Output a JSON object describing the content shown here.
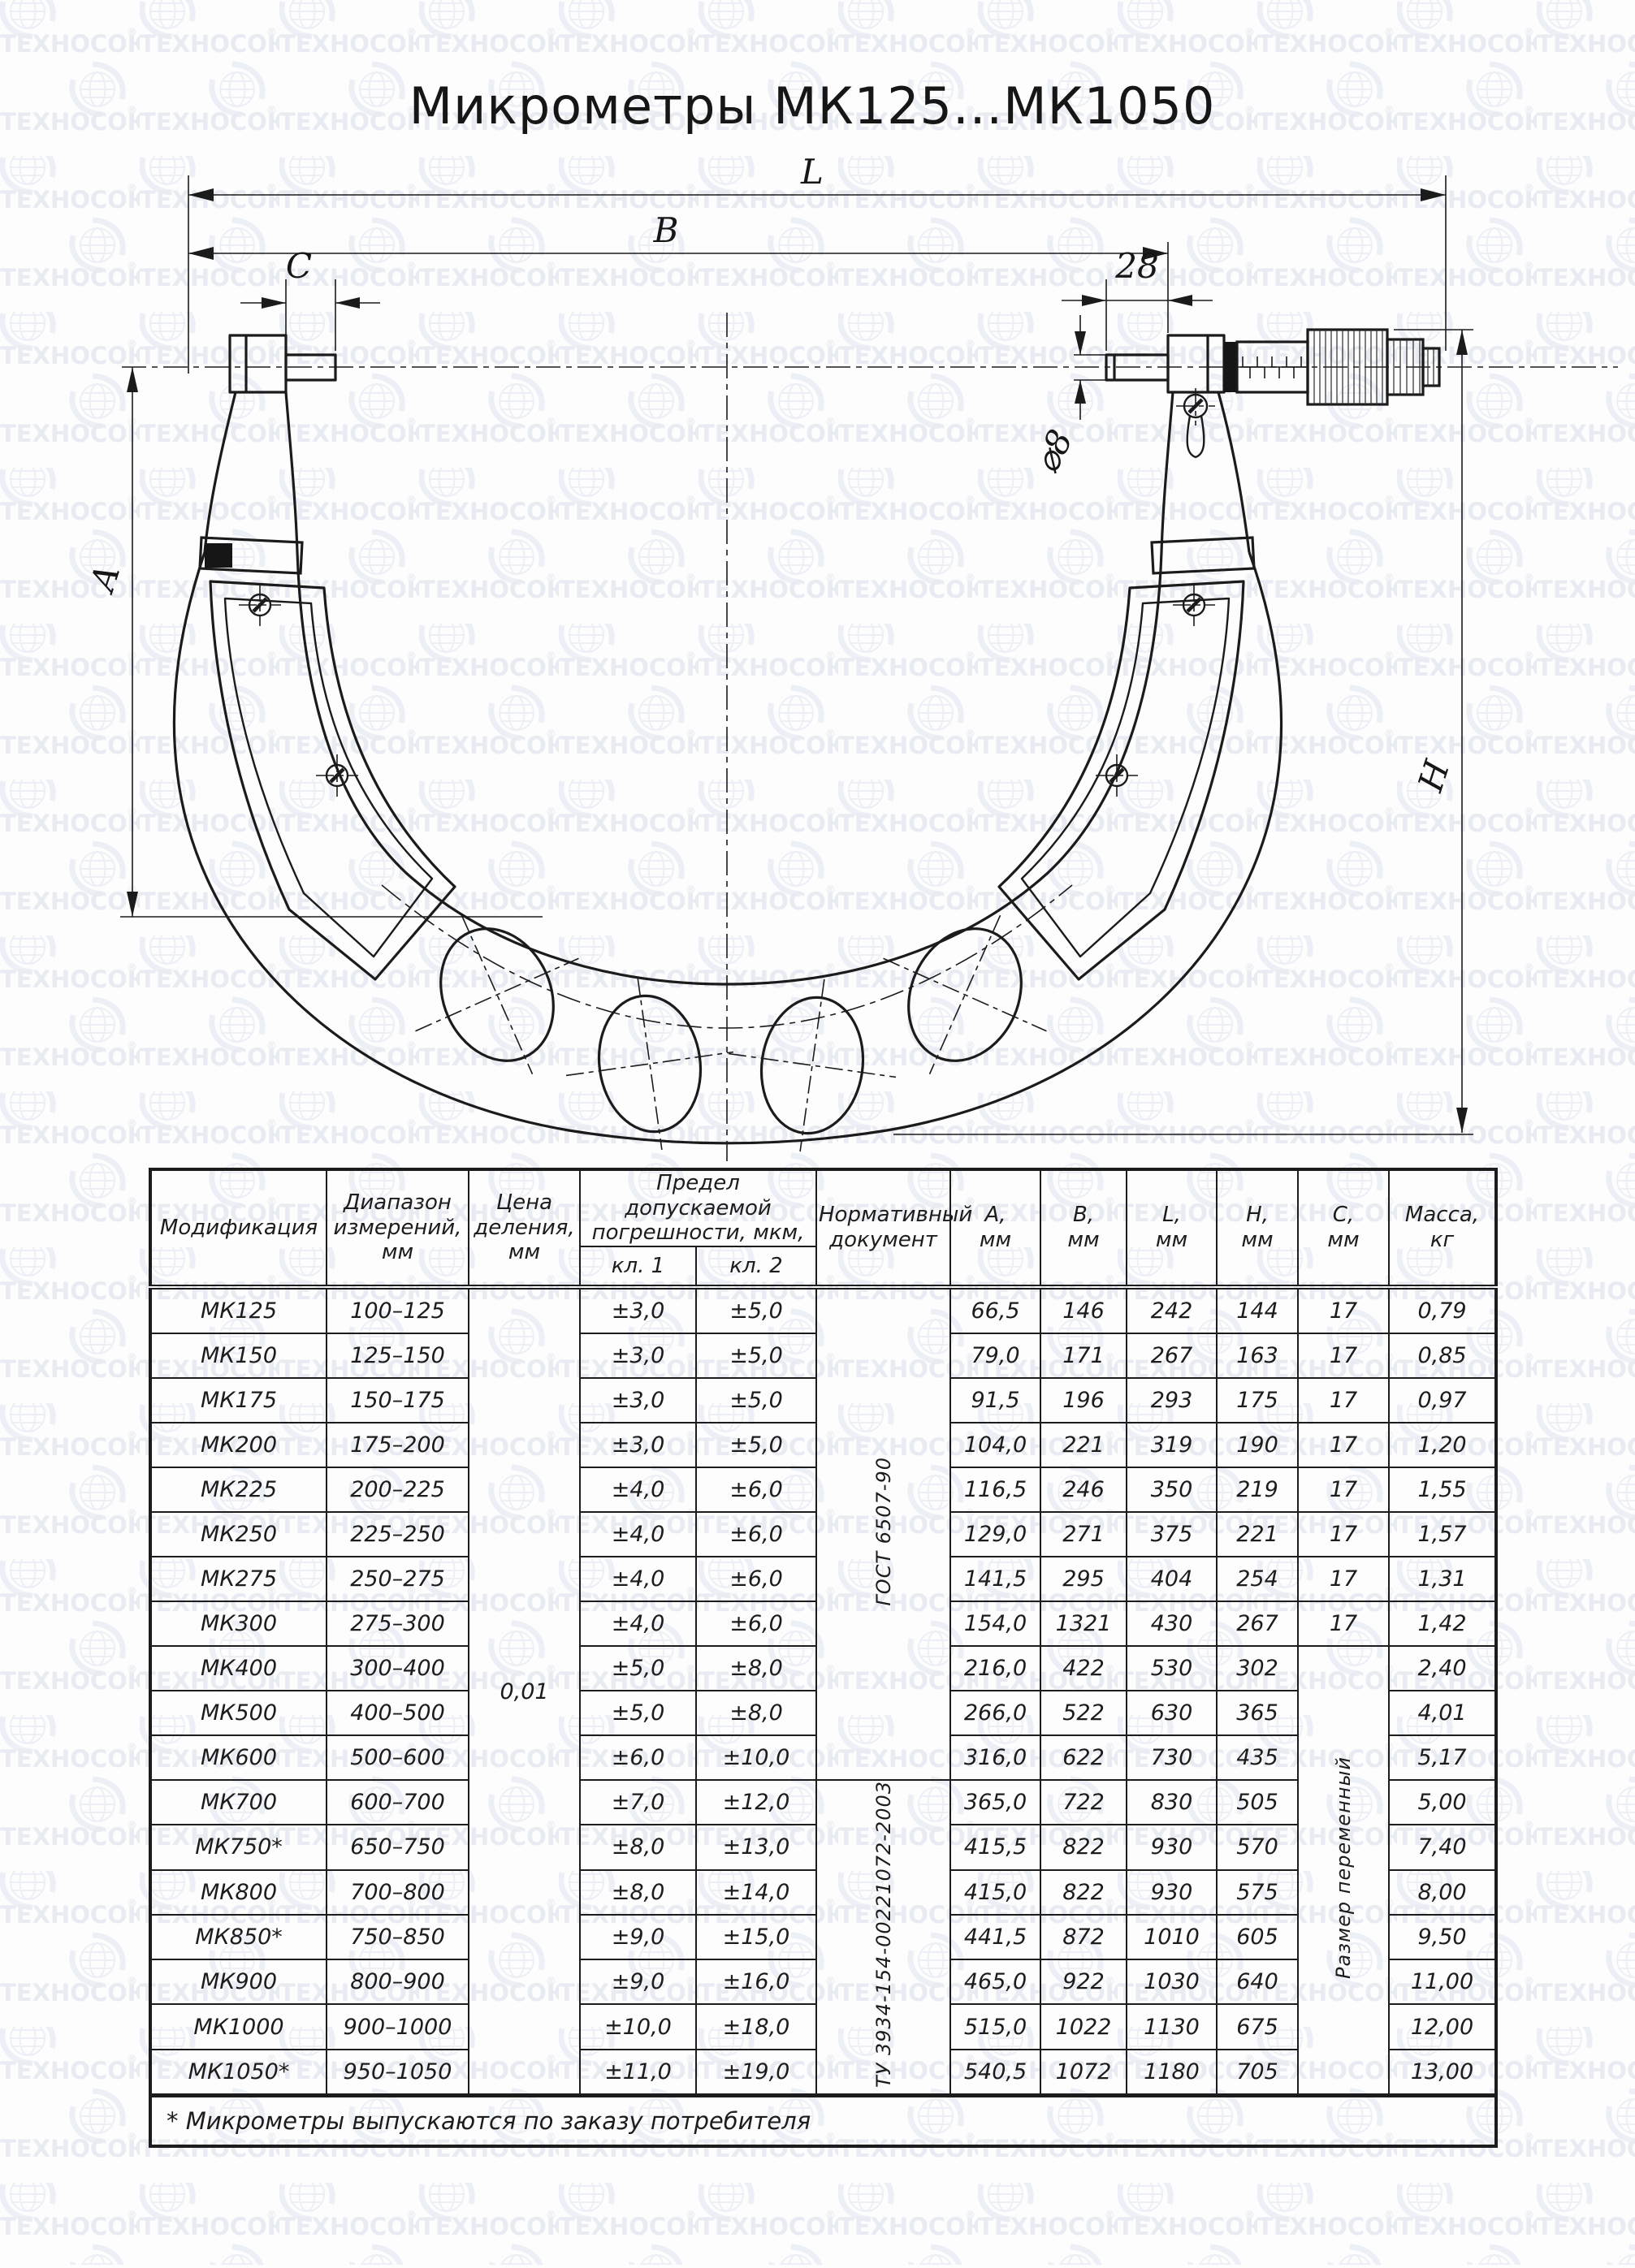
{
  "title": "Микрометры МК125...МК1050",
  "watermark": {
    "text": "ТЕХНОСОЮЗ",
    "reg": "®"
  },
  "drawing": {
    "dims": {
      "L": "L",
      "B": "B",
      "C": "C",
      "d28": "28",
      "dia8": "⌀8",
      "A": "A",
      "H": "H"
    }
  },
  "table": {
    "headers": {
      "modification": "Модификация",
      "range": "Диапазон\nизмерений,\nмм",
      "step": "Цена\nделения,\nмм",
      "error_limit": "Предел допускаемой\nпогрешности, мкм,",
      "class1": "кл. 1",
      "class2": "кл. 2",
      "document": "Нормативный\nдокумент",
      "a": "А,\nмм",
      "b": "В,\nмм",
      "l": "L,\nмм",
      "h": "Н,\nмм",
      "c": "С,\nмм",
      "mass": "Масса,\nкг"
    },
    "step_value": "0,01",
    "documents": {
      "gost": "ГОСТ 6507-90",
      "gost_rows": 11,
      "tu": "ТУ 3934-154-00221072-2003",
      "tu_rows": 7
    },
    "c_variable": {
      "label": "Размер переменный",
      "rows": 10
    },
    "rows": [
      {
        "model": "МК125",
        "range": "100–125",
        "kl1": "±3,0",
        "kl2": "±5,0",
        "a": "66,5",
        "b": "146",
        "l": "242",
        "h": "144",
        "c": "17",
        "mass": "0,79"
      },
      {
        "model": "МК150",
        "range": "125–150",
        "kl1": "±3,0",
        "kl2": "±5,0",
        "a": "79,0",
        "b": "171",
        "l": "267",
        "h": "163",
        "c": "17",
        "mass": "0,85"
      },
      {
        "model": "МК175",
        "range": "150–175",
        "kl1": "±3,0",
        "kl2": "±5,0",
        "a": "91,5",
        "b": "196",
        "l": "293",
        "h": "175",
        "c": "17",
        "mass": "0,97"
      },
      {
        "model": "МК200",
        "range": "175–200",
        "kl1": "±3,0",
        "kl2": "±5,0",
        "a": "104,0",
        "b": "221",
        "l": "319",
        "h": "190",
        "c": "17",
        "mass": "1,20"
      },
      {
        "model": "МК225",
        "range": "200–225",
        "kl1": "±4,0",
        "kl2": "±6,0",
        "a": "116,5",
        "b": "246",
        "l": "350",
        "h": "219",
        "c": "17",
        "mass": "1,55"
      },
      {
        "model": "МК250",
        "range": "225–250",
        "kl1": "±4,0",
        "kl2": "±6,0",
        "a": "129,0",
        "b": "271",
        "l": "375",
        "h": "221",
        "c": "17",
        "mass": "1,57"
      },
      {
        "model": "МК275",
        "range": "250–275",
        "kl1": "±4,0",
        "kl2": "±6,0",
        "a": "141,5",
        "b": "295",
        "l": "404",
        "h": "254",
        "c": "17",
        "mass": "1,31"
      },
      {
        "model": "МК300",
        "range": "275–300",
        "kl1": "±4,0",
        "kl2": "±6,0",
        "a": "154,0",
        "b": "1321",
        "l": "430",
        "h": "267",
        "c": "17",
        "mass": "1,42"
      },
      {
        "model": "МК400",
        "range": "300–400",
        "kl1": "±5,0",
        "kl2": "±8,0",
        "a": "216,0",
        "b": "422",
        "l": "530",
        "h": "302",
        "c": "",
        "mass": "2,40"
      },
      {
        "model": "МК500",
        "range": "400–500",
        "kl1": "±5,0",
        "kl2": "±8,0",
        "a": "266,0",
        "b": "522",
        "l": "630",
        "h": "365",
        "c": "",
        "mass": "4,01"
      },
      {
        "model": "МК600",
        "range": "500–600",
        "kl1": "±6,0",
        "kl2": "±10,0",
        "a": "316,0",
        "b": "622",
        "l": "730",
        "h": "435",
        "c": "",
        "mass": "5,17"
      },
      {
        "model": "МК700",
        "range": "600–700",
        "kl1": "±7,0",
        "kl2": "±12,0",
        "a": "365,0",
        "b": "722",
        "l": "830",
        "h": "505",
        "c": "",
        "mass": "5,00"
      },
      {
        "model": "МК750*",
        "range": "650–750",
        "kl1": "±8,0",
        "kl2": "±13,0",
        "a": "415,5",
        "b": "822",
        "l": "930",
        "h": "570",
        "c": "",
        "mass": "7,40"
      },
      {
        "model": "МК800",
        "range": "700–800",
        "kl1": "±8,0",
        "kl2": "±14,0",
        "a": "415,0",
        "b": "822",
        "l": "930",
        "h": "575",
        "c": "",
        "mass": "8,00"
      },
      {
        "model": "МК850*",
        "range": "750–850",
        "kl1": "±9,0",
        "kl2": "±15,0",
        "a": "441,5",
        "b": "872",
        "l": "1010",
        "h": "605",
        "c": "",
        "mass": "9,50"
      },
      {
        "model": "МК900",
        "range": "800–900",
        "kl1": "±9,0",
        "kl2": "±16,0",
        "a": "465,0",
        "b": "922",
        "l": "1030",
        "h": "640",
        "c": "",
        "mass": "11,00"
      },
      {
        "model": "МК1000",
        "range": "900–1000",
        "kl1": "±10,0",
        "kl2": "±18,0",
        "a": "515,0",
        "b": "1022",
        "l": "1130",
        "h": "675",
        "c": "",
        "mass": "12,00"
      },
      {
        "model": "МК1050*",
        "range": "950–1050",
        "kl1": "±11,0",
        "kl2": "±19,0",
        "a": "540,5",
        "b": "1072",
        "l": "1180",
        "h": "705",
        "c": "",
        "mass": "13,00"
      }
    ],
    "footnote": "* Микрометры выпускаются по заказу потребителя"
  }
}
